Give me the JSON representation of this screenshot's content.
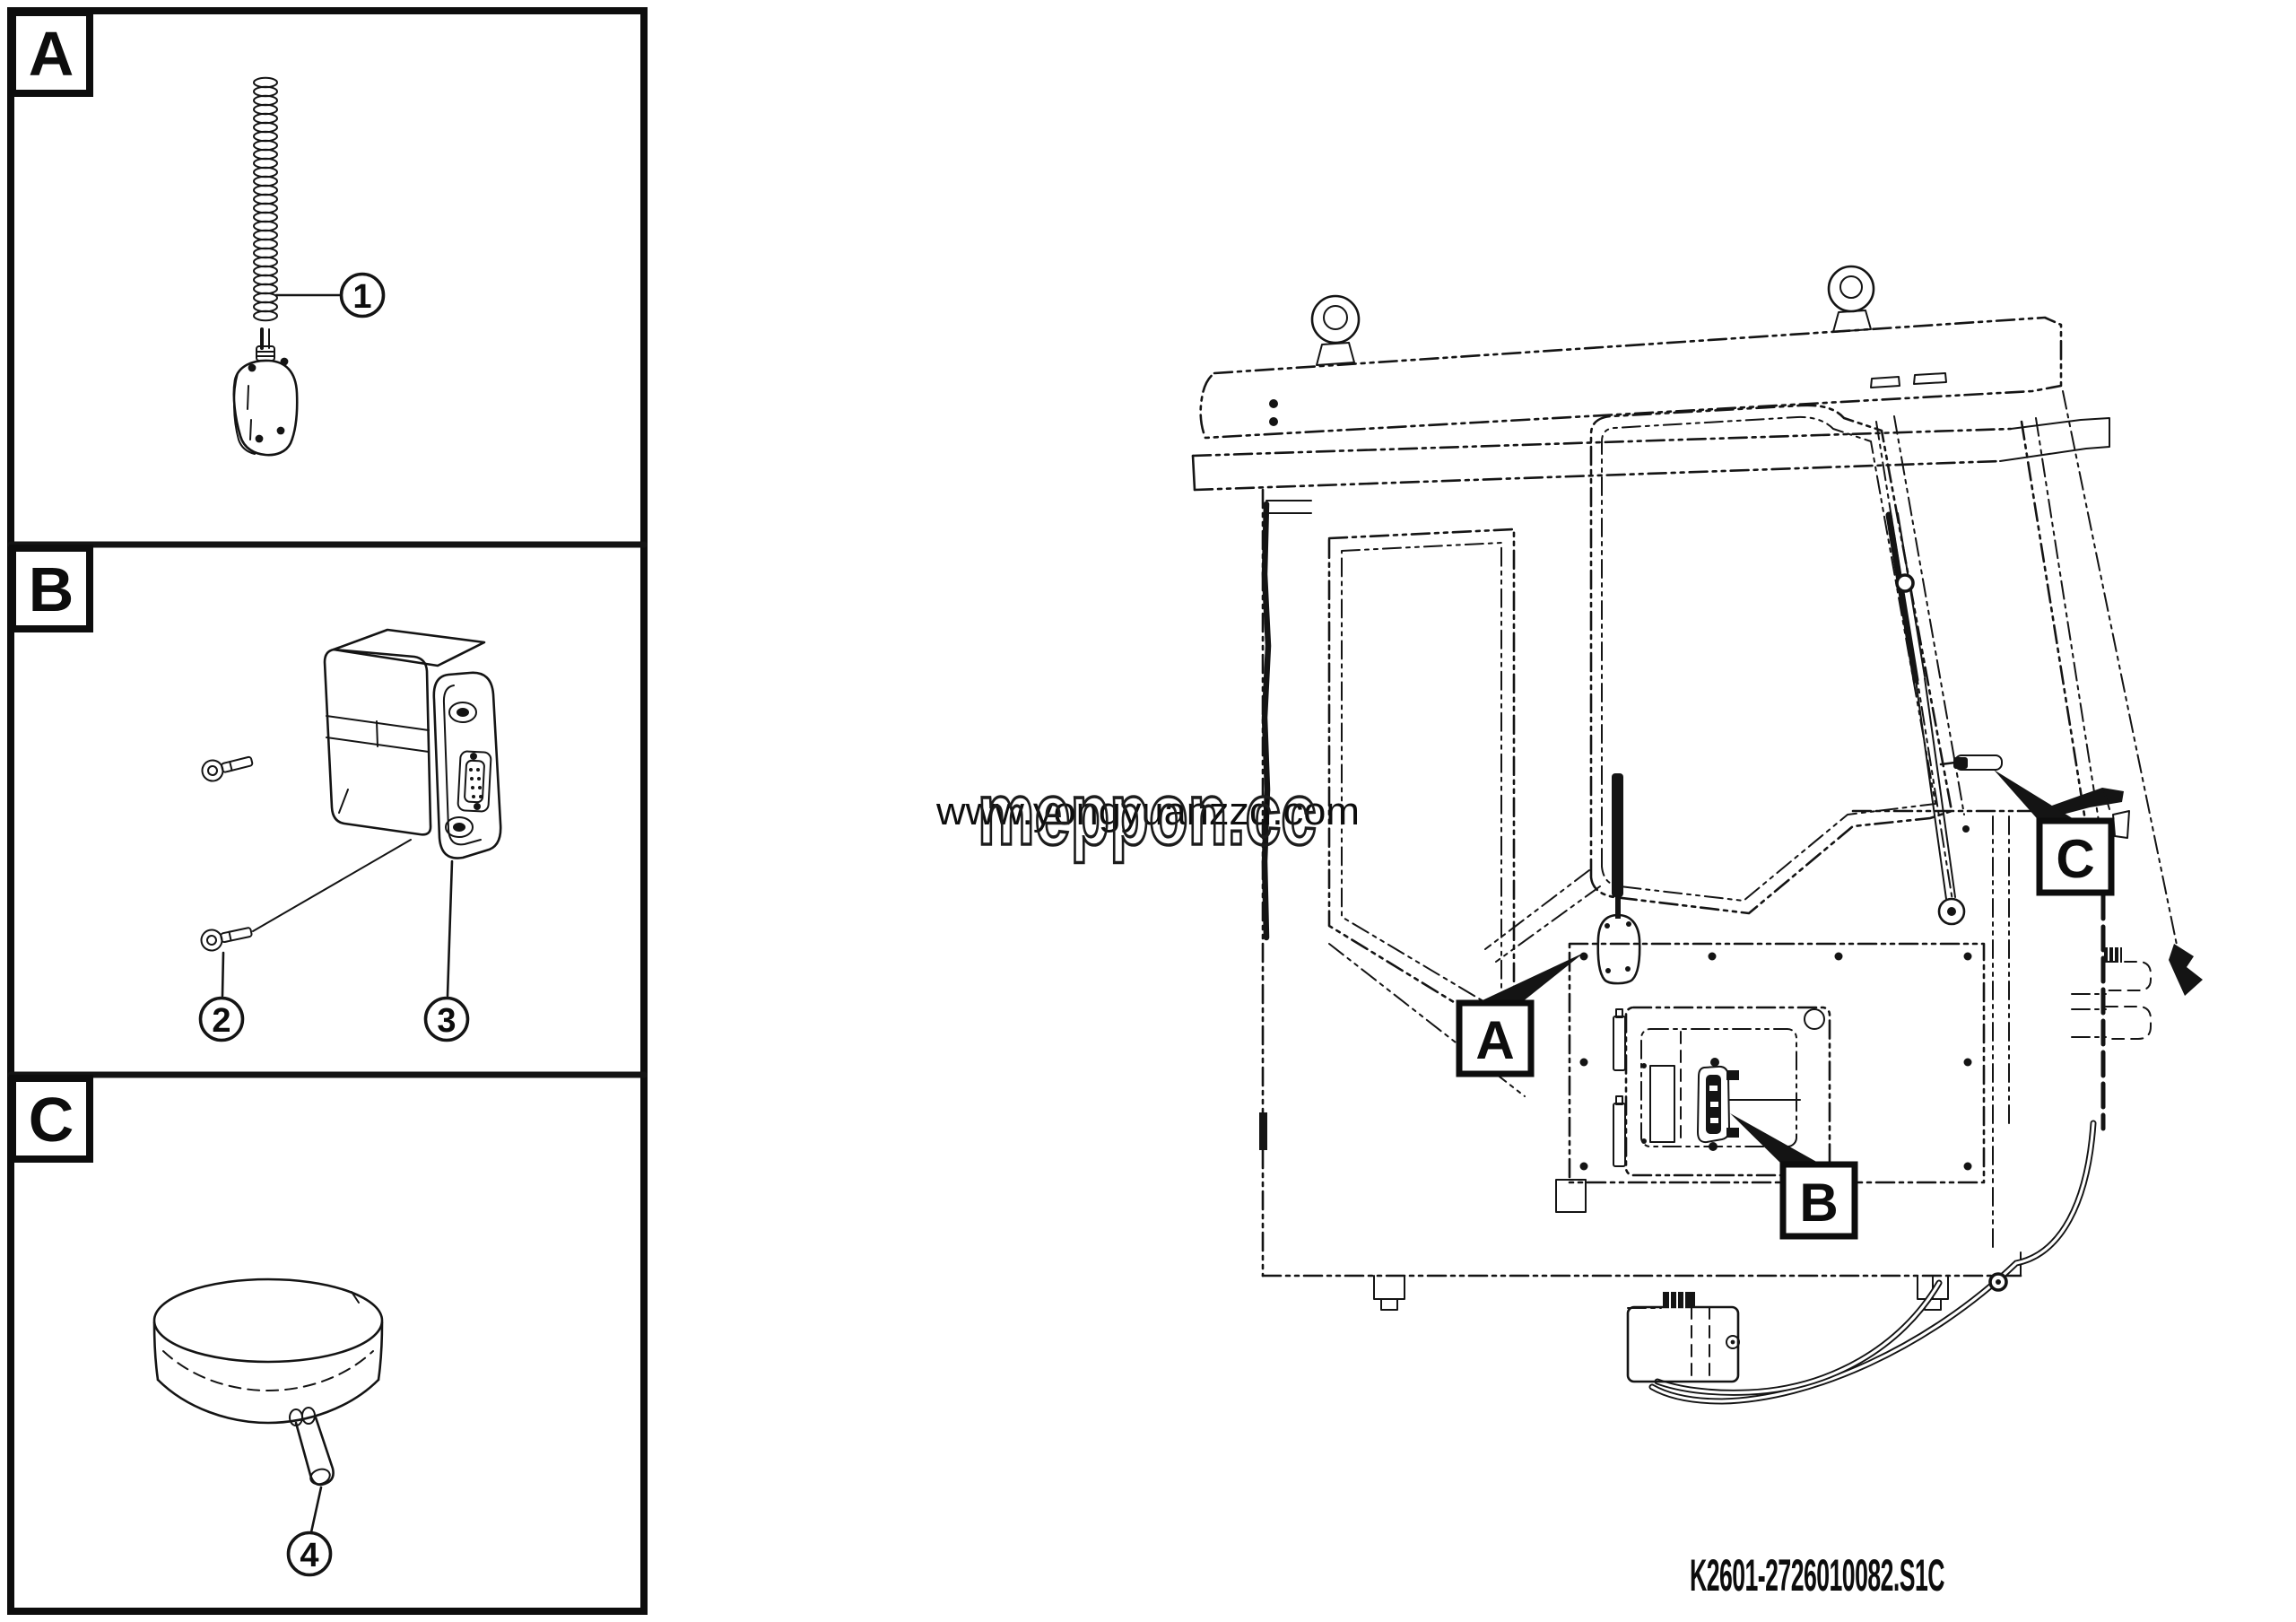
{
  "document": {
    "drawing_number": "K2601-2726010082.S1C"
  },
  "watermark": {
    "url_text": "www.yongyuanzzd.com",
    "brand_text": "meppon.cc",
    "url_color": "#2b7ec1"
  },
  "detail_sections": [
    {
      "label": "A",
      "callouts": [
        {
          "number": "1"
        }
      ]
    },
    {
      "label": "B",
      "callouts": [
        {
          "number": "2"
        },
        {
          "number": "3"
        }
      ]
    },
    {
      "label": "C",
      "callouts": [
        {
          "number": "4"
        }
      ]
    }
  ],
  "cab_view": {
    "location_labels": [
      {
        "label": "A"
      },
      {
        "label": "B"
      },
      {
        "label": "C"
      }
    ]
  },
  "colors": {
    "line": "#141414",
    "background": "#ffffff",
    "watermark_blue": "#2b7ec1"
  }
}
